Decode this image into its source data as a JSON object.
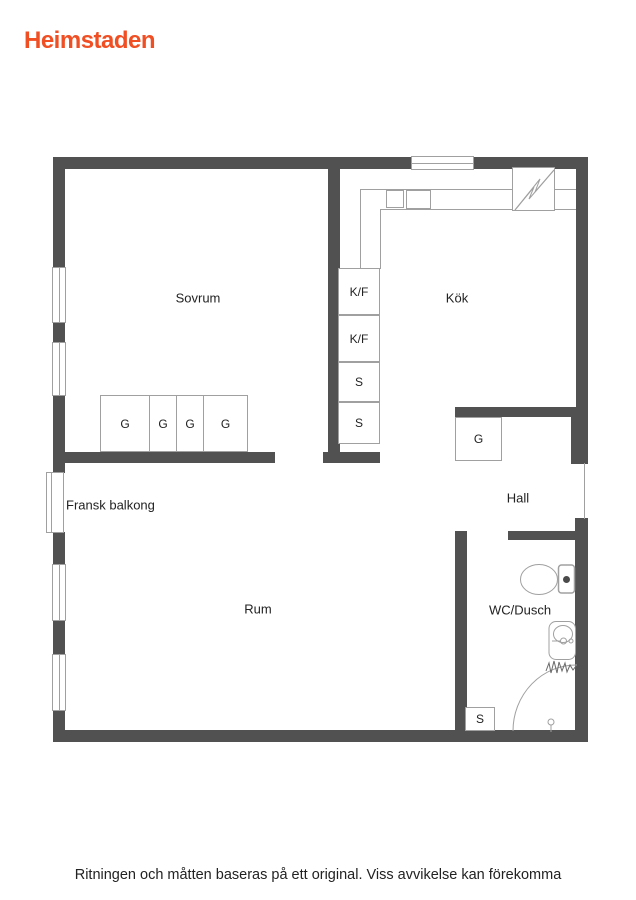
{
  "brand": {
    "name": "Heimstaden"
  },
  "colors": {
    "brand": "#F04E23",
    "wall": "#515151",
    "line": "#A0A0A0",
    "text": "#222222"
  },
  "floorplan": {
    "rooms": {
      "sovrum": "Sovrum",
      "kok": "Kök",
      "hall": "Hall",
      "rum": "Rum",
      "wc_dusch": "WC/Dusch",
      "fransk_balkong": "Fransk balkong"
    },
    "appliances": {
      "kf_top": "K/F",
      "kf_bottom": "K/F",
      "s_top": "S",
      "s_bottom": "S"
    },
    "closets": {
      "sovrum_wardrobes": [
        "G",
        "G",
        "G",
        "G"
      ],
      "hall_wardrobe": "G",
      "wc_cabinet": "S"
    },
    "icons": {
      "electrical_panel": "lightning-bolt",
      "toilet": "toilet-top-view",
      "sink": "washbasin-top-view",
      "shower": "corner-shower-with-curtain-and-drain",
      "window": "double-line-window-symbol",
      "balcony_door": "french-balcony-door-symbol"
    }
  },
  "footer": {
    "disclaimer": "Ritningen och måtten baseras på ett original. Viss avvikelse kan förekomma"
  }
}
